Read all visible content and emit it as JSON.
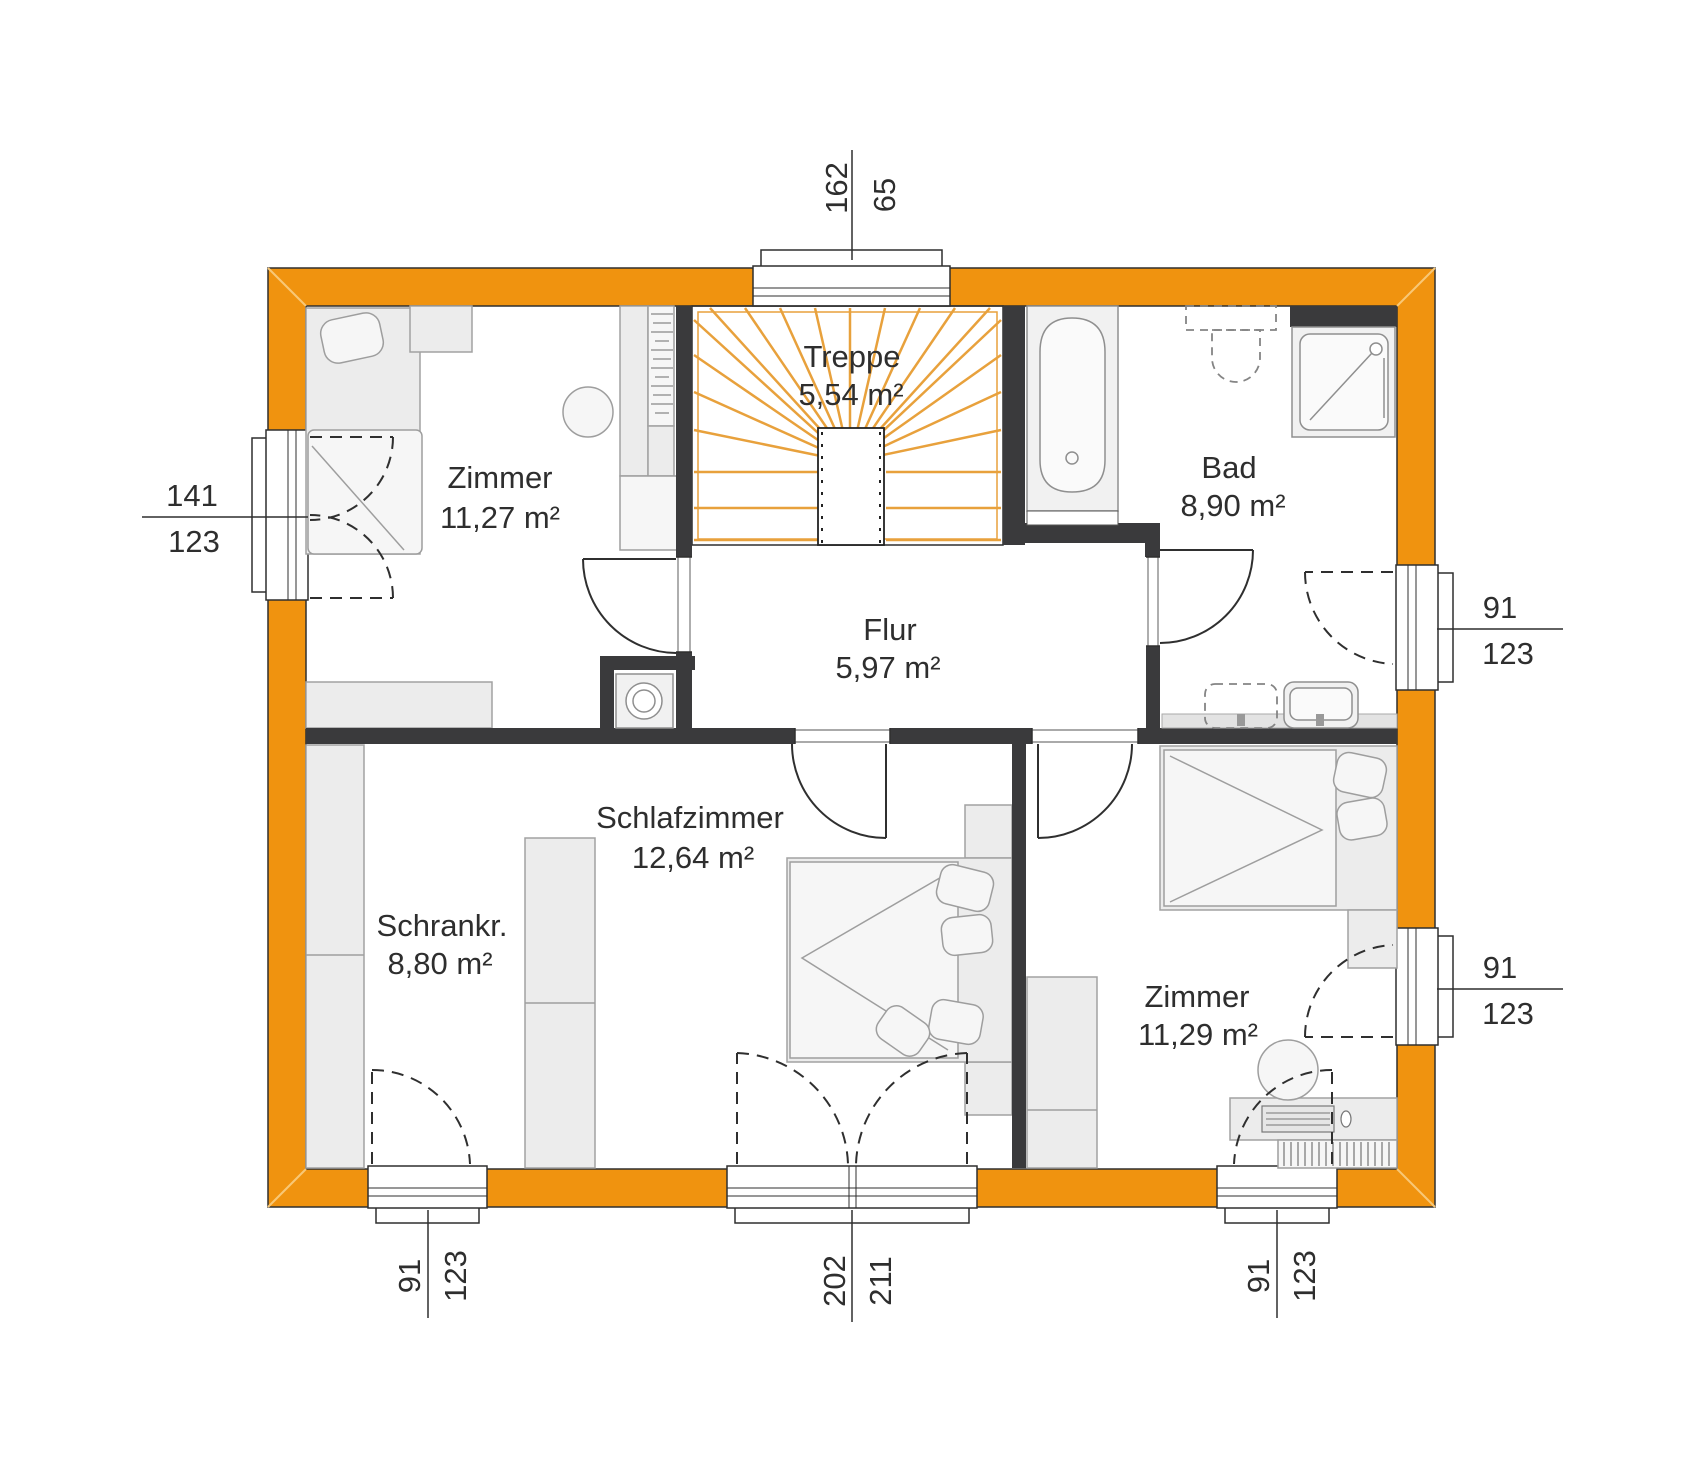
{
  "plan": {
    "rooms": {
      "treppe": {
        "name": "Treppe",
        "area": "5,54 m²"
      },
      "zimmer_tl": {
        "name": "Zimmer",
        "area": "11,27 m²"
      },
      "bad": {
        "name": "Bad",
        "area": "8,90 m²"
      },
      "flur": {
        "name": "Flur",
        "area": "5,97 m²"
      },
      "schlafzimmer": {
        "name": "Schlafzimmer",
        "area": "12,64 m²"
      },
      "schrankraum": {
        "name": "Schrankr.",
        "area": "8,80 m²"
      },
      "zimmer_br": {
        "name": "Zimmer",
        "area": "11,29 m²"
      }
    },
    "dimensions": {
      "top": {
        "a": "162",
        "b": "65"
      },
      "left": {
        "a": "141",
        "b": "123"
      },
      "right_bad": {
        "a": "91",
        "b": "123"
      },
      "right_zimmer": {
        "a": "91",
        "b": "123"
      },
      "bottom_left": {
        "a": "91",
        "b": "123"
      },
      "bottom_middle": {
        "a": "202",
        "b": "211"
      },
      "bottom_right": {
        "a": "91",
        "b": "123"
      }
    },
    "colors": {
      "wall": "#F0930F",
      "tread": "#E8A13C",
      "interior_wall": "#3A3A3C"
    }
  }
}
